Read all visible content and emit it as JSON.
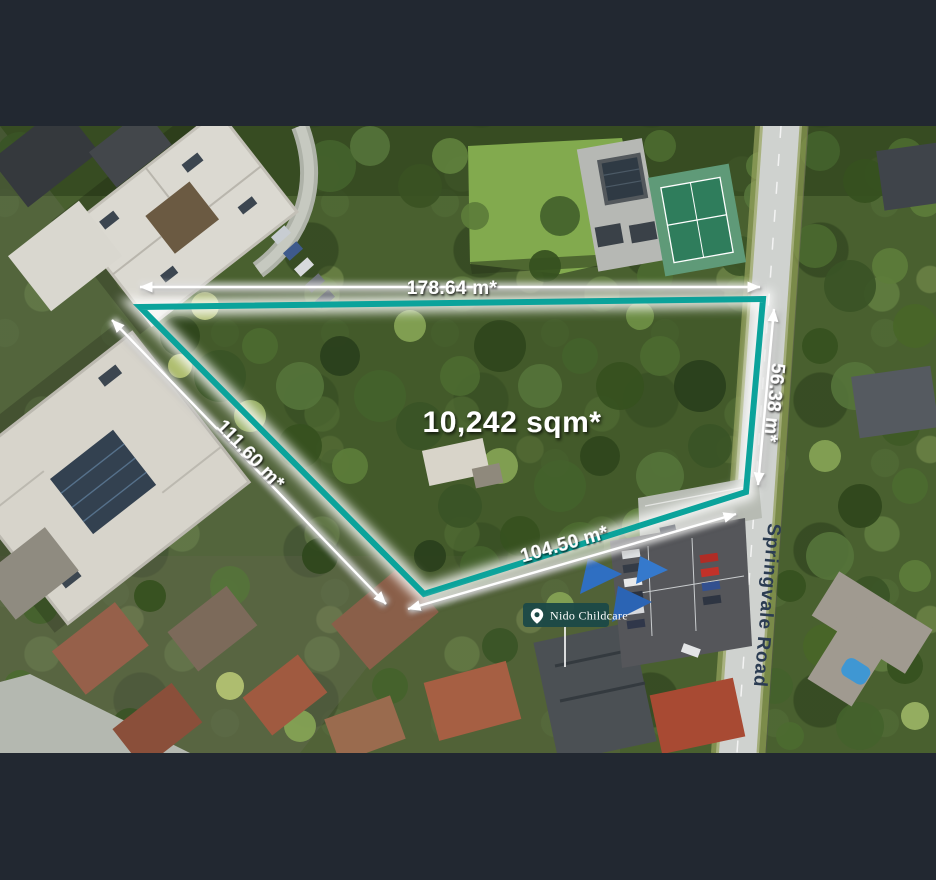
{
  "frame": {
    "bar_color": "#222831"
  },
  "overlay": {
    "boundary_color": "#0ba39b",
    "area_label": "10,242 sqm*",
    "dimensions": {
      "top": "178.64 m*",
      "right": "56.38 m*",
      "bottom": "104.50 m*",
      "left_diag": "111.60 m*"
    },
    "marker": {
      "label": "Nido Childcare",
      "background": "#1c4947",
      "icon": "location-pin-icon"
    },
    "road_label": "Springvale Road",
    "road_label_color": "#2b3c52"
  }
}
